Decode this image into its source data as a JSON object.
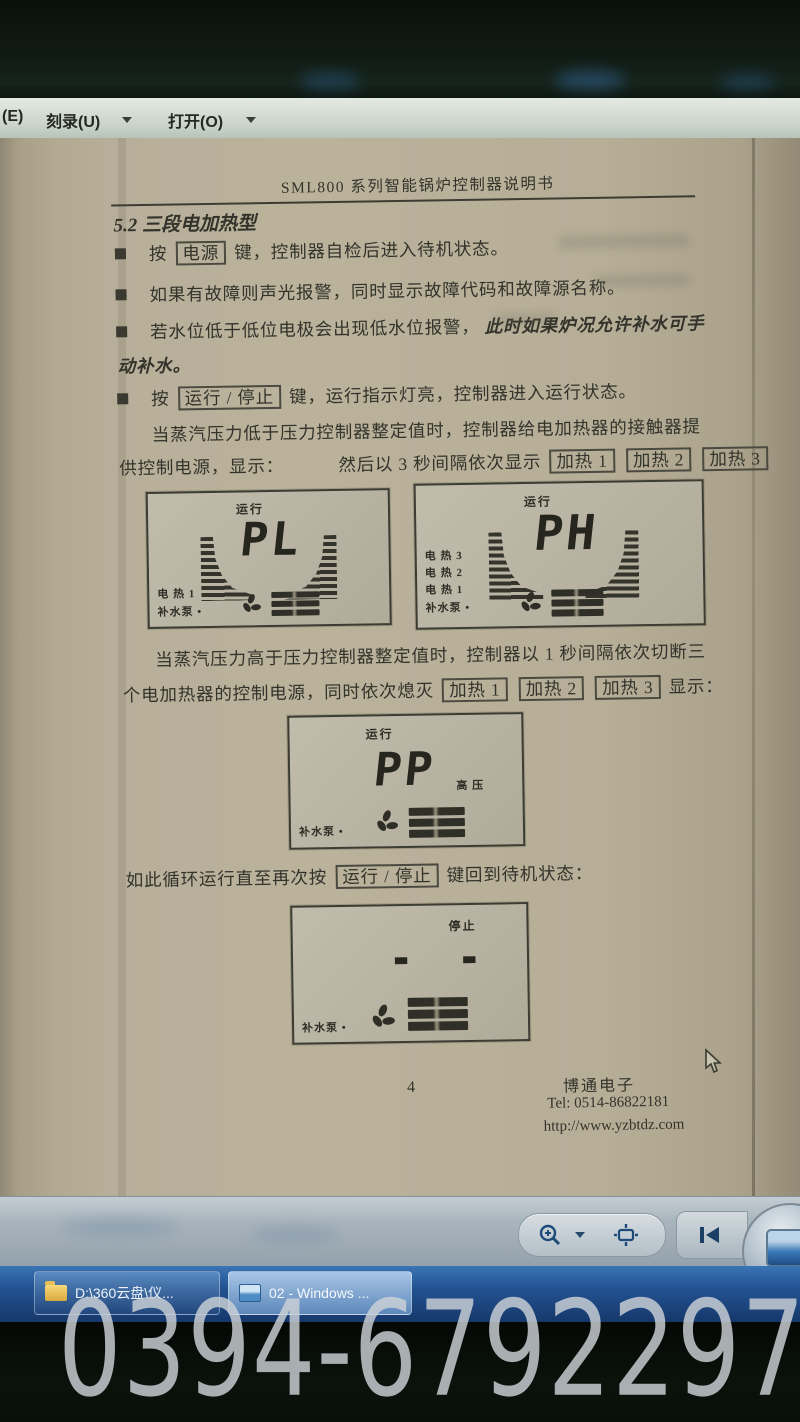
{
  "watermark": "0394-6792297",
  "menubar": {
    "item_e": "(E)",
    "burn": "刻录(U)",
    "open": "打开(O)"
  },
  "doc": {
    "header": "SML800 系列智能锅炉控制器说明书",
    "section": "5.2 三段电加热型",
    "b1_pre": "按",
    "key_power": "电源",
    "b1_post": "键，控制器自检后进入待机状态。",
    "b2": "如果有故障则声光报警，同时显示故障代码和故障源名称。",
    "b3_pre": "若水位低于低位电极会出现低水位报警，",
    "b3_em": "此时如果炉况允许补水可手",
    "b3_cont": "动补水。",
    "b4_pre": "按",
    "key_runstop": "运行 / 停止",
    "b4_post": "键，运行指示灯亮，控制器进入运行状态。",
    "p1_l1": "当蒸汽压力低于压力控制器整定值时，控制器给电加热器的接触器提",
    "p1_l2a": "供控制电源，显示：",
    "p1_l2b": "然后以 3 秒间隔依次显示",
    "key_heat1": "加热 1",
    "key_heat2": "加热 2",
    "key_heat3": "加热 3",
    "p2_l1": "当蒸汽压力高于压力控制器整定值时，控制器以 1 秒间隔依次切断三",
    "p2_l2a": "个电加热器的控制电源，同时依次熄灭",
    "p2_l2b": "显示：",
    "loop_pre": "如此循环运行直至再次按",
    "loop_post": "键回到待机状态：",
    "footer_page": "4",
    "footer_company": "博通电子",
    "footer_tel": "Tel: 0514-86822181",
    "footer_url": "http://www.yzbtdz.com"
  },
  "lcd1": {
    "status": "运行",
    "value": "PL",
    "row1": "电 热  1",
    "row2": "补水泵 •"
  },
  "lcd2": {
    "status": "运行",
    "value": "PH",
    "row1": "电 热  3",
    "row2": "电 热  2",
    "row3": "电 热  1",
    "row4": "补水泵 •"
  },
  "lcd3": {
    "status": "运行",
    "value": "PP",
    "side": "高  压",
    "row1": "补水泵 •"
  },
  "lcd4": {
    "status": "停止",
    "value": "- -",
    "row1": "补水泵 •"
  },
  "taskbar": {
    "app1": "D:\\360云盘\\仪...",
    "app2": "02 - Windows ..."
  },
  "accent_colors": {
    "paper": "#b7af99",
    "taskbar_blue": "#235291",
    "chrome_gray": "#a9b5bd",
    "ink": "#33332b"
  }
}
